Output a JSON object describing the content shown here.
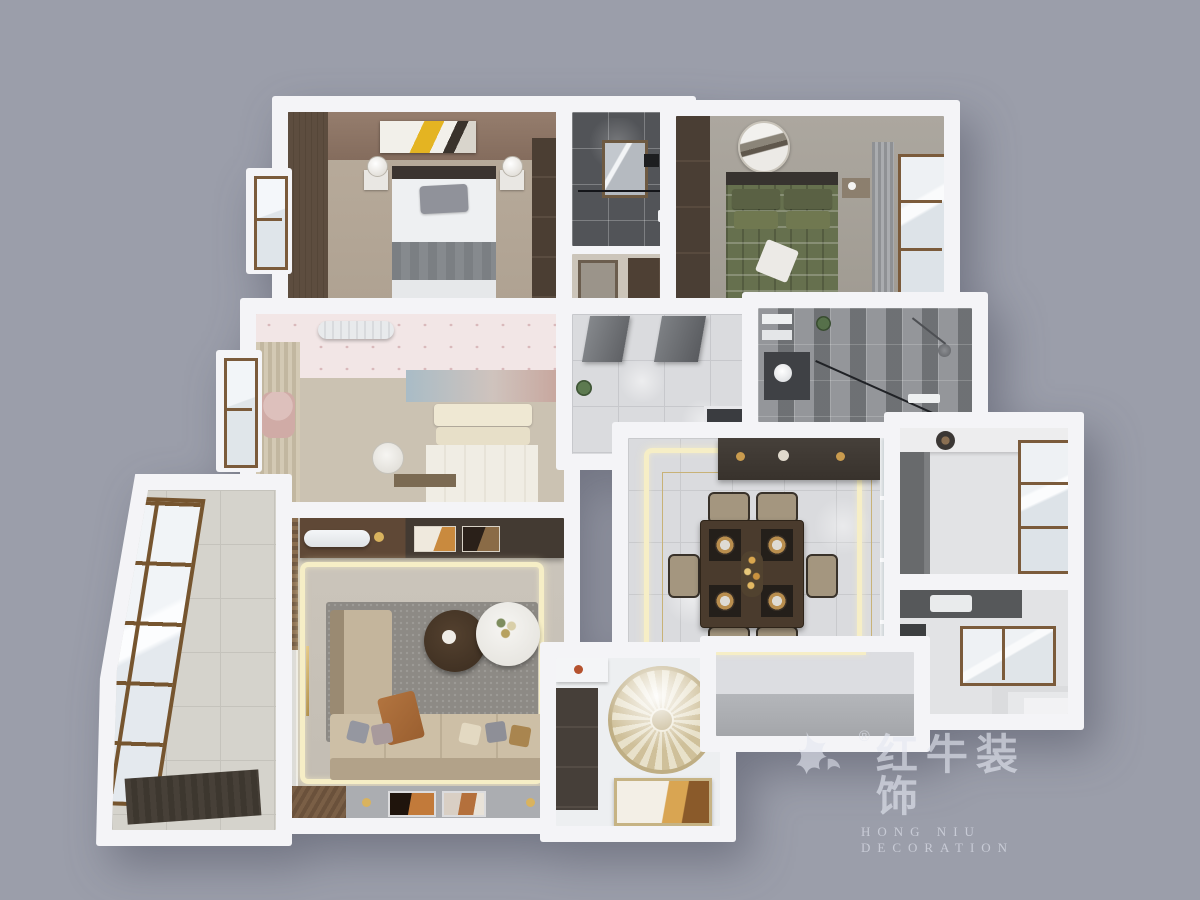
{
  "meta": {
    "type": "3d-apartment-floorplan-render",
    "view": "top-down-dollhouse"
  },
  "watermark": {
    "brand_cn": "红牛装饰",
    "brand_en": "HONG NIU DECORATION",
    "registered": "®",
    "logo": "bull-swoosh-icon"
  },
  "palette": {
    "bg": "#9b9eaa",
    "wall": "#f4f4f7",
    "gold": "#c8b277",
    "led": "#f6eec6",
    "marble": "#dadbde",
    "woodDark": "#4a3e33",
    "woodMid": "#6f5740",
    "woodFrame": "#7b5b3b",
    "greenBed": "#66704e",
    "pinkWall": "#f2e6e6",
    "beige": "#cbc2b2",
    "sofa": "#cdbfa6",
    "rug": "#8d8a85",
    "tileDark": "#55565a",
    "glass": "#eef1f4",
    "stone": "#d5d3cc",
    "grayBand": "#abadb1",
    "watermark": "rgba(228,231,240,.62)"
  },
  "rooms": [
    {
      "id": "master-bedroom",
      "features": [
        "brown-accent-wall",
        "abstract-art",
        "double-bed",
        "two-nightstand-lamps",
        "wardrobe",
        "left-window-bay"
      ]
    },
    {
      "id": "bathroom-dark",
      "features": [
        "dark-gray-tiles",
        "mirror",
        "shower-screen"
      ]
    },
    {
      "id": "closet-nook",
      "features": [
        "wood-cabinet"
      ]
    },
    {
      "id": "bedroom-green",
      "features": [
        "green-plaid-bed",
        "round-wall-art",
        "wardrobe",
        "gray-curtain",
        "right-window-bay"
      ]
    },
    {
      "id": "bedroom-pink",
      "features": [
        "polka-dot-wallpaper",
        "air-conditioner",
        "beige-curtains",
        "seascape-mural",
        "cream-bed",
        "desk-chair",
        "left-window-bay"
      ]
    },
    {
      "id": "hallway",
      "features": [
        "marble-floor",
        "two-doors",
        "plant",
        "framed-panel"
      ]
    },
    {
      "id": "bathroom-gray",
      "features": [
        "shower-glass",
        "vanity-sink",
        "plant",
        "shelves"
      ]
    },
    {
      "id": "dining-room",
      "features": [
        "led-cove-square",
        "gold-floor-inlay",
        "dining-table-six-chairs",
        "place-settings",
        "sideboard",
        "glass-partition"
      ]
    },
    {
      "id": "kitchen",
      "features": [
        "counters",
        "cooking-pot",
        "two-wood-framed-windows",
        "sink",
        "steps"
      ]
    },
    {
      "id": "living-room",
      "features": [
        "media-console",
        "air-conditioner",
        "led-cove-square",
        "gray-rug",
        "round-coffee-tables",
        "l-shaped-sofa",
        "tv-feature-wall",
        "curtains",
        "gold-floor-lamp"
      ]
    },
    {
      "id": "balcony",
      "features": [
        "slanted-glazed-wall",
        "stone-floor",
        "dark-mat"
      ]
    },
    {
      "id": "entryway",
      "features": [
        "floor-medallion",
        "shoe-cabinet",
        "gold-artwork"
      ]
    },
    {
      "id": "rear-hall",
      "features": [
        "gray-step-band"
      ]
    }
  ]
}
